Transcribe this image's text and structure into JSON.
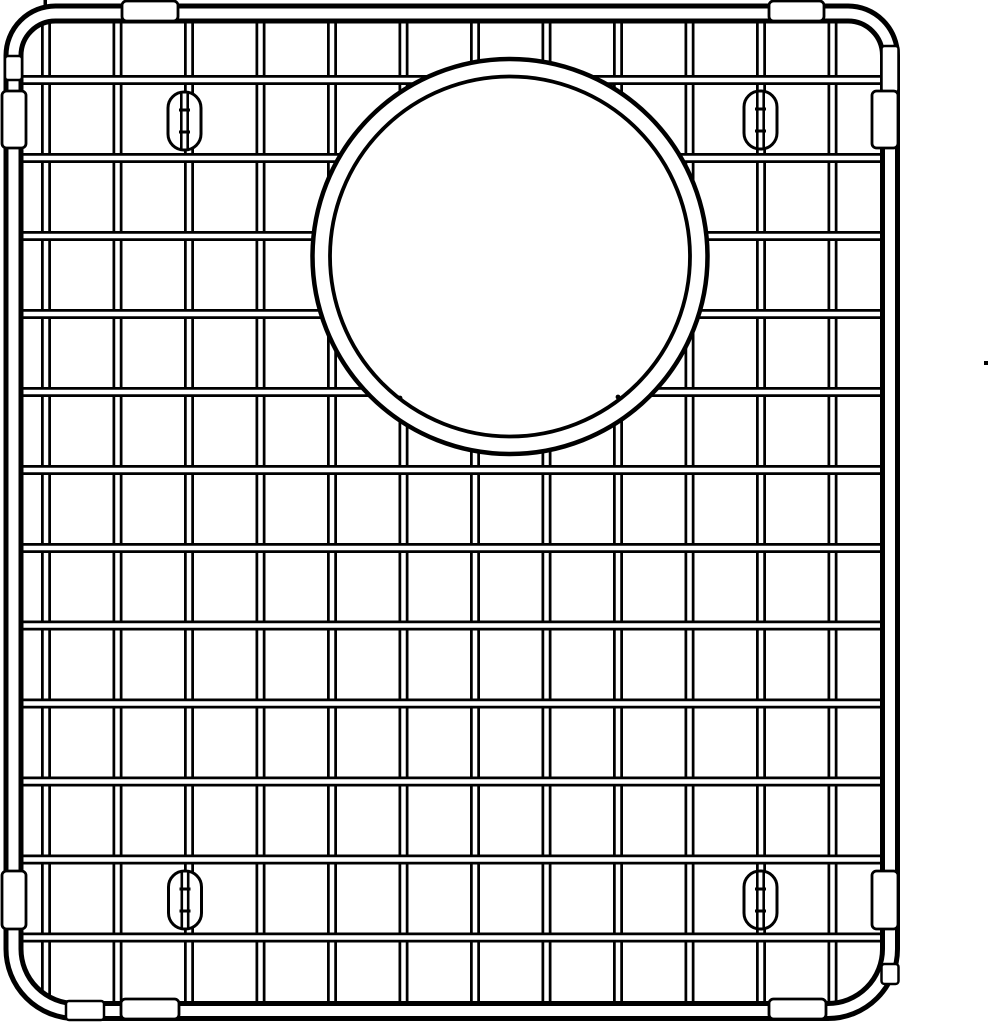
{
  "meta": {
    "title": "Stainless steel sink bottom grid with circular drain opening - line drawing",
    "background_color": "#ffffff",
    "line_color": "#000000"
  },
  "canvas": {
    "width": 991,
    "height": 1024
  },
  "frame": {
    "left": 13.5,
    "top": 13.5,
    "right": 890,
    "bottom": 1011,
    "corner_radius_top": 42,
    "corner_radius_bottom": 62,
    "tube_width": 20,
    "tube_core_width": 10
  },
  "grid": {
    "vertical_wire_x": [
      46,
      117.5,
      189,
      260.5,
      332,
      403.5,
      475,
      546.5,
      618,
      689.5,
      761,
      832.5
    ],
    "horizontal_wire_y": [
      80,
      158,
      236,
      314,
      392,
      470,
      548,
      625.5,
      703.5,
      781.5,
      859.5,
      937.5
    ],
    "vertical_span": [
      15,
      1003
    ],
    "horizontal_span": [
      15,
      887
    ],
    "wire_width": 10,
    "wire_core_width": 4.5
  },
  "drain_opening": {
    "cx": 510,
    "cy": 256.5,
    "outer_radius": 197.5,
    "inner_radius": 180,
    "outer_stroke": 4.5,
    "inner_stroke": 3.8,
    "edge_dots": [
      {
        "x": 400,
        "y": 398
      },
      {
        "x": 618,
        "y": 397
      }
    ],
    "edge_dot_radius": 2.4
  },
  "feet": {
    "width": 33,
    "height": 58,
    "corner_radius": 16,
    "stroke": 3,
    "wire_width": 9,
    "wire_core_width": 3.8,
    "clip_tick_offset": 11,
    "clip_tick_width": 11,
    "clip_tick_height": 3,
    "positions": [
      {
        "name": "top-left",
        "cx": 184.5,
        "cy": 121
      },
      {
        "name": "top-right",
        "cx": 760.5,
        "cy": 120
      },
      {
        "name": "bottom-left",
        "cx": 185,
        "cy": 900
      },
      {
        "name": "bottom-right",
        "cx": 760.5,
        "cy": 900
      }
    ]
  },
  "bumpers": {
    "stroke": 2.8,
    "corner_radius": 4.5,
    "items": [
      {
        "name": "top-left",
        "x": 122,
        "y": 1,
        "w": 56,
        "h": 20
      },
      {
        "name": "top-right",
        "x": 769,
        "y": 1,
        "w": 55,
        "h": 20
      },
      {
        "name": "left-top",
        "x": 2,
        "y": 91,
        "w": 24,
        "h": 57
      },
      {
        "name": "right-top",
        "x": 872,
        "y": 91,
        "w": 26,
        "h": 57
      },
      {
        "name": "left-bottom",
        "x": 2,
        "y": 871,
        "w": 24,
        "h": 58
      },
      {
        "name": "right-bottom",
        "x": 872,
        "y": 871,
        "w": 26,
        "h": 58
      },
      {
        "name": "bottom-left",
        "x": 121,
        "y": 999,
        "w": 58,
        "h": 20
      },
      {
        "name": "bottom-right",
        "x": 769,
        "y": 999,
        "w": 57,
        "h": 20
      }
    ]
  },
  "sleeves": {
    "stroke": 2.5,
    "corner_radius": 3,
    "items": [
      {
        "name": "top-left",
        "x": 5,
        "y": 56,
        "w": 17,
        "h": 24
      },
      {
        "name": "top-right",
        "x": 881.5,
        "y": 46,
        "w": 17,
        "h": 46
      },
      {
        "name": "bottom-left",
        "x": 66,
        "y": 1001,
        "w": 38,
        "h": 19
      },
      {
        "name": "bottom-right",
        "x": 881.5,
        "y": 964,
        "w": 17,
        "h": 20
      }
    ]
  },
  "marks": {
    "top_weld_tick": {
      "x": 43.5,
      "y": 0,
      "w": 3.5,
      "h": 7
    },
    "stray_dot": {
      "x": 984,
      "y": 361,
      "w": 4,
      "h": 4
    }
  }
}
